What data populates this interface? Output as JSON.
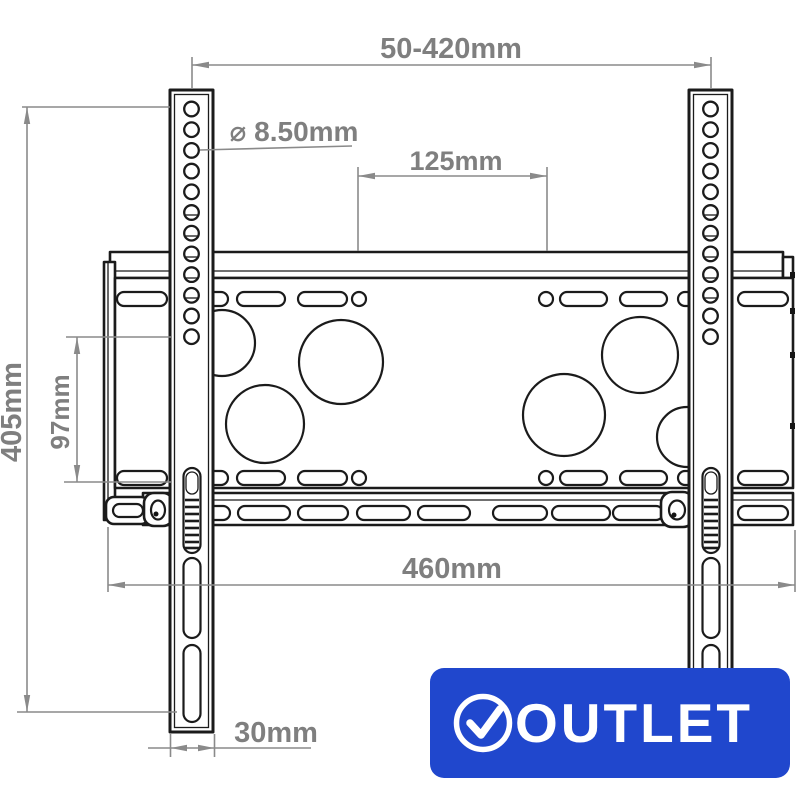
{
  "diagram": {
    "type": "tv-wall-mount-technical-drawing",
    "dimensions": {
      "top_range": "50-420mm",
      "hole_diameter": "⌀ 8.50mm",
      "hole_spacing_horizontal": "125mm",
      "overall_height": "405mm",
      "slot_spacing_vertical": "97mm",
      "plate_width": "460mm",
      "bracket_width": "30mm"
    },
    "badge": {
      "label": "OUTLET",
      "icon": "check-circle",
      "background_color": "#2047cd",
      "text_color": "#ffffff"
    },
    "colors": {
      "drawing_line": "#1b1b1b",
      "dimension_line": "#8a8a8a",
      "dimension_text": "#7f7f7f"
    }
  }
}
